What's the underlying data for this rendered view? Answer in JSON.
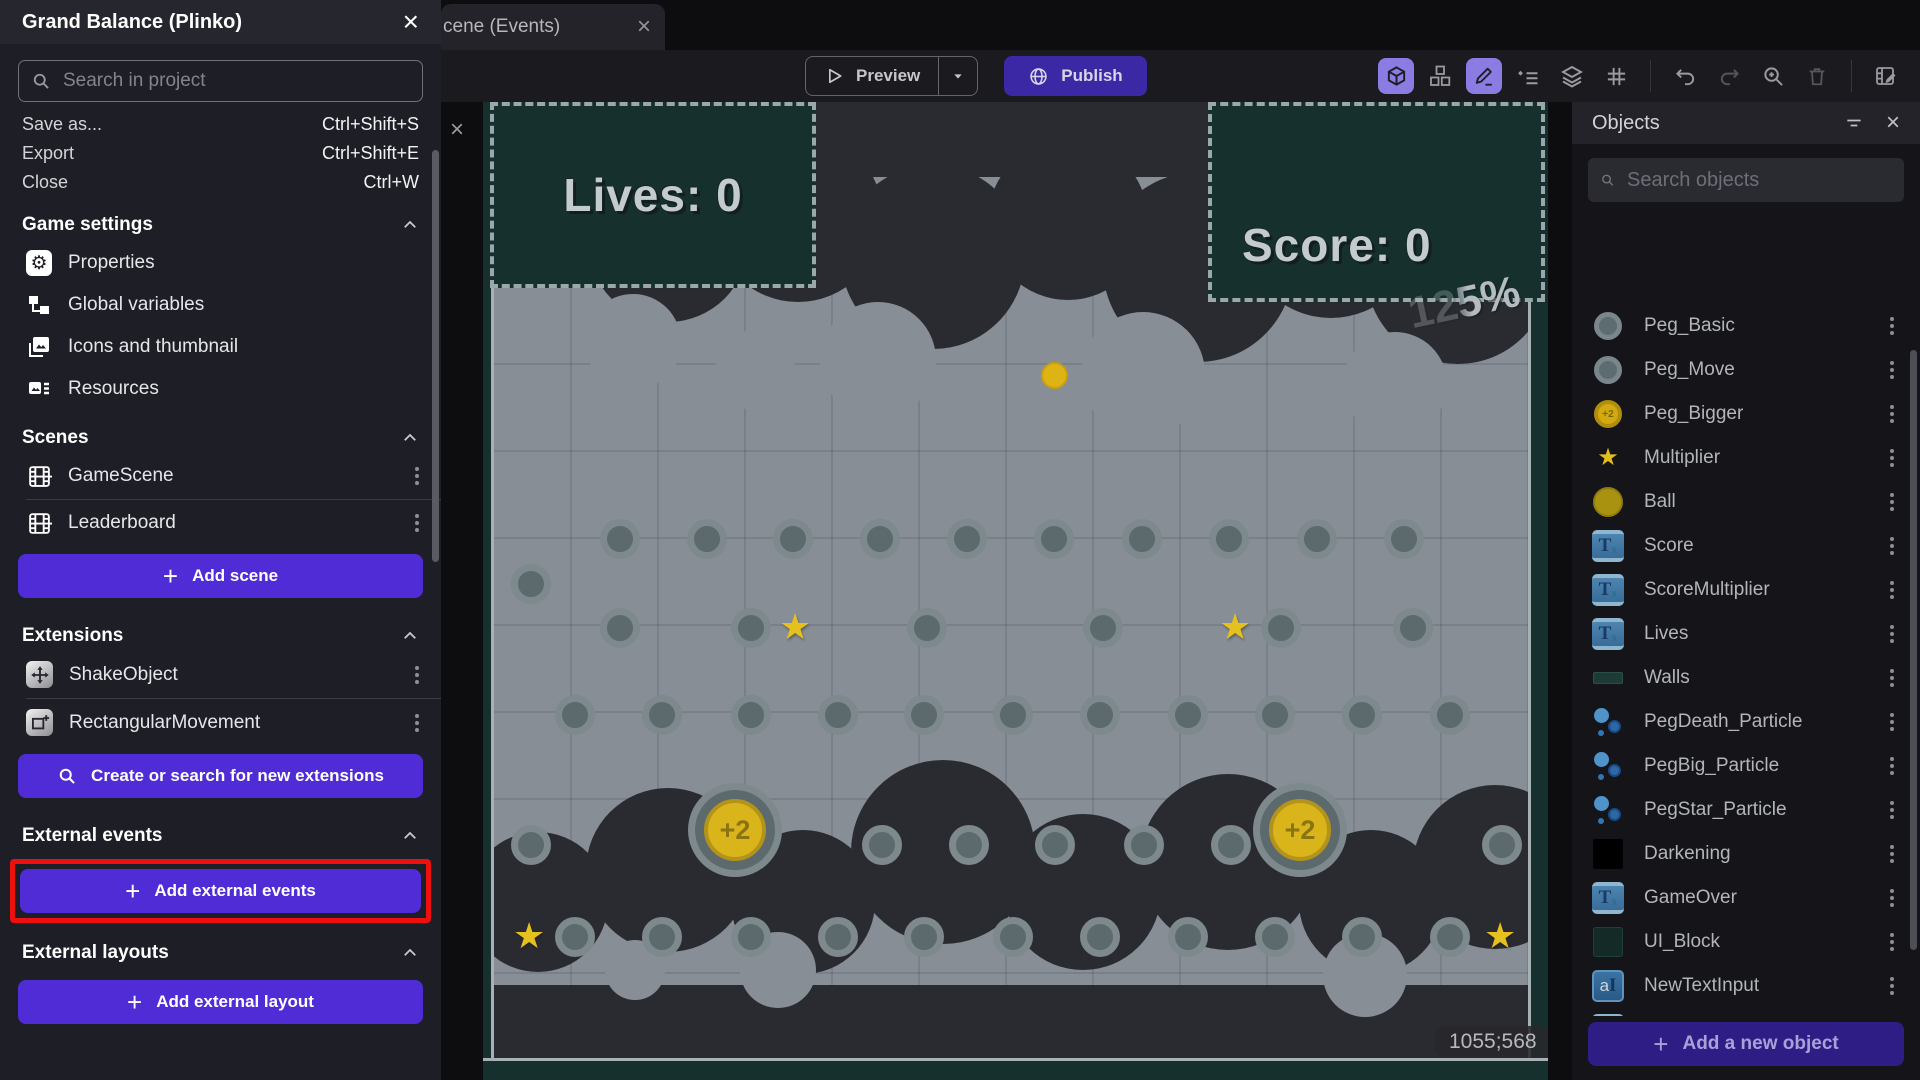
{
  "left_panel": {
    "title": "Grand Balance (Plinko)",
    "search_placeholder": "Search in project",
    "menu": [
      {
        "label": "Save as...",
        "shortcut": "Ctrl+Shift+S"
      },
      {
        "label": "Export",
        "shortcut": "Ctrl+Shift+E"
      },
      {
        "label": "Close",
        "shortcut": "Ctrl+W"
      }
    ],
    "sections": {
      "game_settings": {
        "title": "Game settings",
        "items": [
          "Properties",
          "Global variables",
          "Icons and thumbnail",
          "Resources"
        ]
      },
      "scenes": {
        "title": "Scenes",
        "items": [
          "GameScene",
          "Leaderboard"
        ],
        "add_label": "Add scene"
      },
      "extensions": {
        "title": "Extensions",
        "items": [
          "ShakeObject",
          "RectangularMovement"
        ],
        "search_label": "Create or search for new extensions"
      },
      "external_events": {
        "title": "External events",
        "add_label": "Add external events"
      },
      "external_layouts": {
        "title": "External layouts",
        "add_label": "Add external layout"
      }
    }
  },
  "tab": {
    "label": "cene (Events)"
  },
  "toolbar": {
    "preview_label": "Preview",
    "publish_label": "Publish",
    "icons": [
      "objects-panel",
      "instances",
      "edit-properties",
      "instances-list",
      "layers",
      "grid",
      "undo",
      "redo",
      "zoom-in",
      "delete",
      "edit-events"
    ]
  },
  "objects_panel": {
    "title": "Objects",
    "search_placeholder": "Search objects",
    "add_label": "Add a new object",
    "items": [
      {
        "name": "Peg_Basic",
        "icon": "peg"
      },
      {
        "name": "Peg_Move",
        "icon": "peg"
      },
      {
        "name": "Peg_Bigger",
        "icon": "coin"
      },
      {
        "name": "Multiplier",
        "icon": "star"
      },
      {
        "name": "Ball",
        "icon": "ball"
      },
      {
        "name": "Score",
        "icon": "text"
      },
      {
        "name": "ScoreMultiplier",
        "icon": "text"
      },
      {
        "name": "Lives",
        "icon": "text"
      },
      {
        "name": "Walls",
        "icon": "wall"
      },
      {
        "name": "PegDeath_Particle",
        "icon": "particle"
      },
      {
        "name": "PegBig_Particle",
        "icon": "particle"
      },
      {
        "name": "PegStar_Particle",
        "icon": "particle"
      },
      {
        "name": "Darkening",
        "icon": "black"
      },
      {
        "name": "GameOver",
        "icon": "text"
      },
      {
        "name": "UI_Block",
        "icon": "block"
      },
      {
        "name": "NewTextInput",
        "icon": "textinput"
      },
      {
        "name": "SubmitScore",
        "icon": "text"
      },
      {
        "name": "RestartGame",
        "icon": "text"
      }
    ]
  },
  "canvas": {
    "hud": {
      "lives": "Lives: 0",
      "score": "Score: 0",
      "multiplier": "125%"
    },
    "coordinates": "1055;568",
    "coin_label": "+2",
    "ball": [
      1054,
      375
    ],
    "pegs": [
      [
        620,
        539
      ],
      [
        707,
        539
      ],
      [
        793,
        539
      ],
      [
        880,
        539
      ],
      [
        967,
        539
      ],
      [
        1054,
        539
      ],
      [
        1142,
        539
      ],
      [
        1229,
        539
      ],
      [
        1317,
        539
      ],
      [
        1404,
        539
      ],
      [
        531,
        584
      ],
      [
        620,
        628
      ],
      [
        751,
        628
      ],
      [
        927,
        628
      ],
      [
        1103,
        628
      ],
      [
        1281,
        628
      ],
      [
        1413,
        628
      ],
      [
        575,
        715
      ],
      [
        662,
        715
      ],
      [
        751,
        715
      ],
      [
        838,
        715
      ],
      [
        924,
        715
      ],
      [
        1013,
        715
      ],
      [
        1100,
        715
      ],
      [
        1188,
        715
      ],
      [
        1275,
        715
      ],
      [
        1362,
        715
      ],
      [
        1450,
        715
      ],
      [
        531,
        845
      ],
      [
        882,
        845
      ],
      [
        969,
        845
      ],
      [
        1055,
        845
      ],
      [
        1144,
        845
      ],
      [
        1231,
        845
      ],
      [
        1502,
        845
      ],
      [
        575,
        937
      ],
      [
        662,
        937
      ],
      [
        751,
        937
      ],
      [
        838,
        937
      ],
      [
        924,
        937
      ],
      [
        1013,
        937
      ],
      [
        1100,
        937
      ],
      [
        1188,
        937
      ],
      [
        1275,
        937
      ],
      [
        1362,
        937
      ],
      [
        1450,
        937
      ]
    ],
    "stars": [
      [
        797,
        628
      ],
      [
        1237,
        628
      ],
      [
        531,
        937
      ],
      [
        1502,
        937
      ]
    ],
    "coins": [
      [
        735,
        830
      ],
      [
        1300,
        830
      ]
    ]
  },
  "colors": {
    "accent_purple": "#4f2cd5",
    "publish_purple": "#3b28a5",
    "add_object_purple": "#2d1d85",
    "highlight_red": "#ee0f0f",
    "canvas_bg": "#878e95",
    "cloud": "#2a2b30",
    "panel_teal": "#16302d",
    "peg_ring": "#7d898d",
    "coin_yellow": "#d9b41a",
    "star_yellow": "#e6c01f"
  }
}
